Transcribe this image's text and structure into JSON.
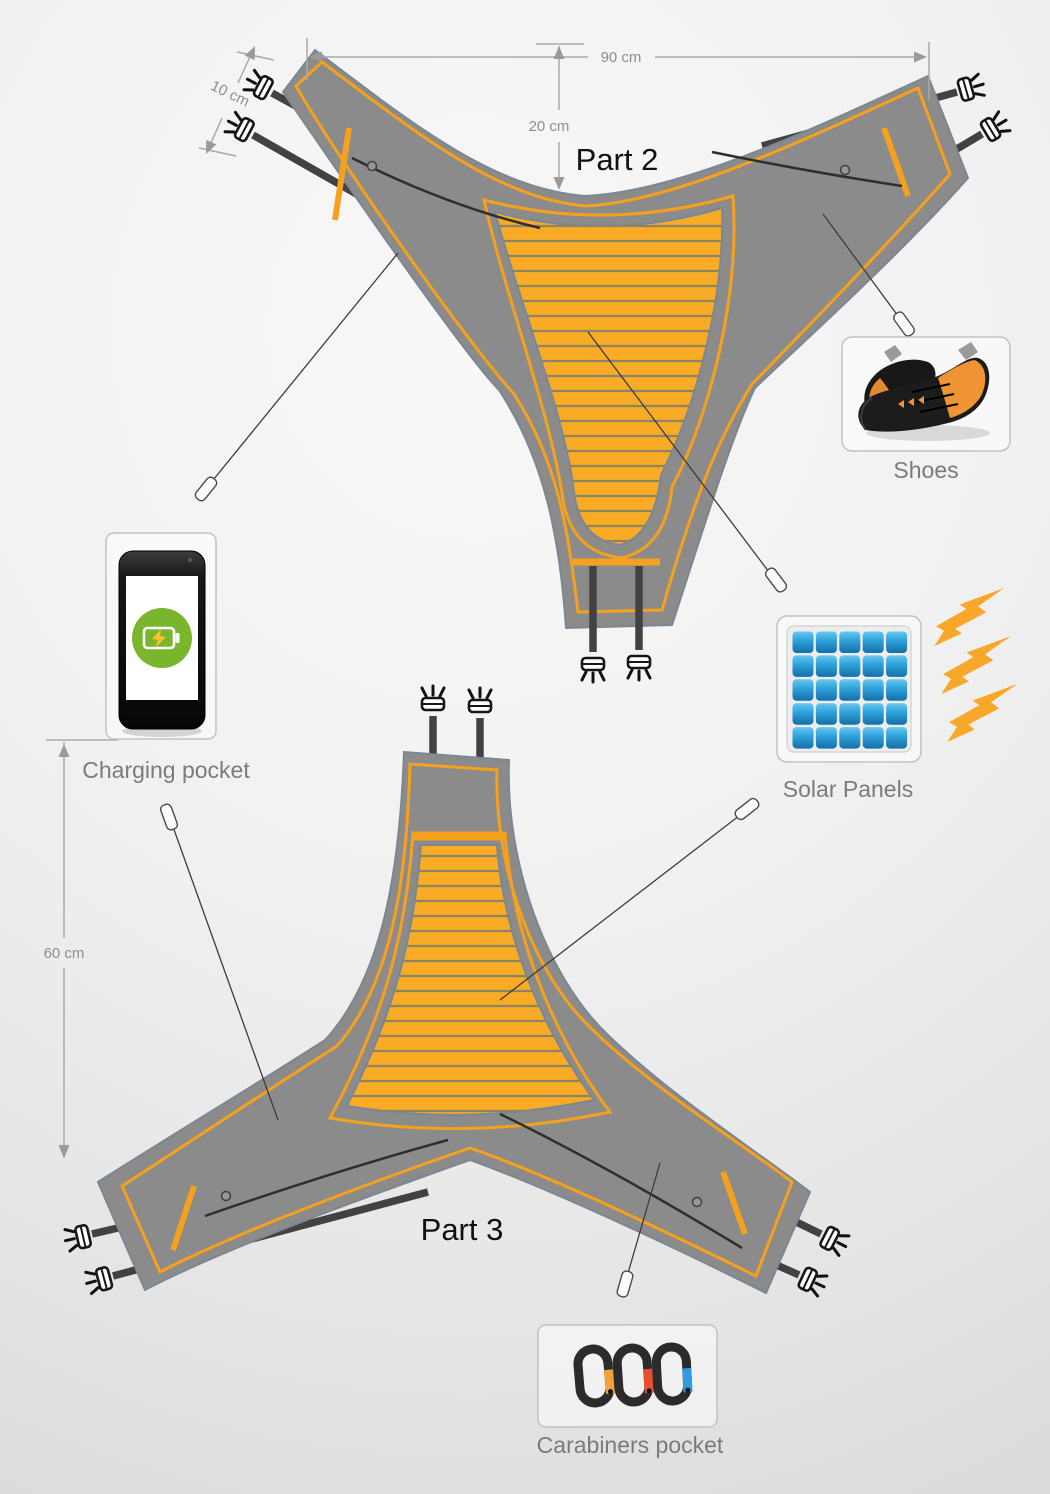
{
  "labels": {
    "part2": "Part 2",
    "part3": "Part 3"
  },
  "callouts": {
    "shoes": "Shoes",
    "charging": "Charging pocket",
    "solar": "Solar Panels",
    "carabiners": "Carabiners pocket"
  },
  "dimensions": {
    "width": "90 cm",
    "notch_depth": "20 cm",
    "strap_spacing": "10 cm",
    "height": "60 cm"
  },
  "colors": {
    "accent_orange": "#F5A11D",
    "panel_orange": "#F9AB26",
    "fabric_gray": "#8B8B8B",
    "outline_blue_gray": "#7A8794",
    "panel_stripe": "#8B8564",
    "strap_dark": "#424242",
    "battery_green": "#7AB62D",
    "solar_cell_blue": "#2D9FD8",
    "carabiner_gate_orange": "#F2A136",
    "carabiner_gate_red": "#E84F2E",
    "carabiner_gate_blue": "#2F9BE0",
    "dimension_gray": "#9A9A9A",
    "label_gray": "#7C7C7C"
  },
  "icons": [
    "climbing-shoes-icon",
    "smartphone-icon",
    "battery-charge-icon",
    "solar-panel-icon",
    "sun-ray-arrow-icon",
    "carabiner-icon",
    "strap-buckle-icon",
    "zipper-pull-icon",
    "callout-marker"
  ]
}
